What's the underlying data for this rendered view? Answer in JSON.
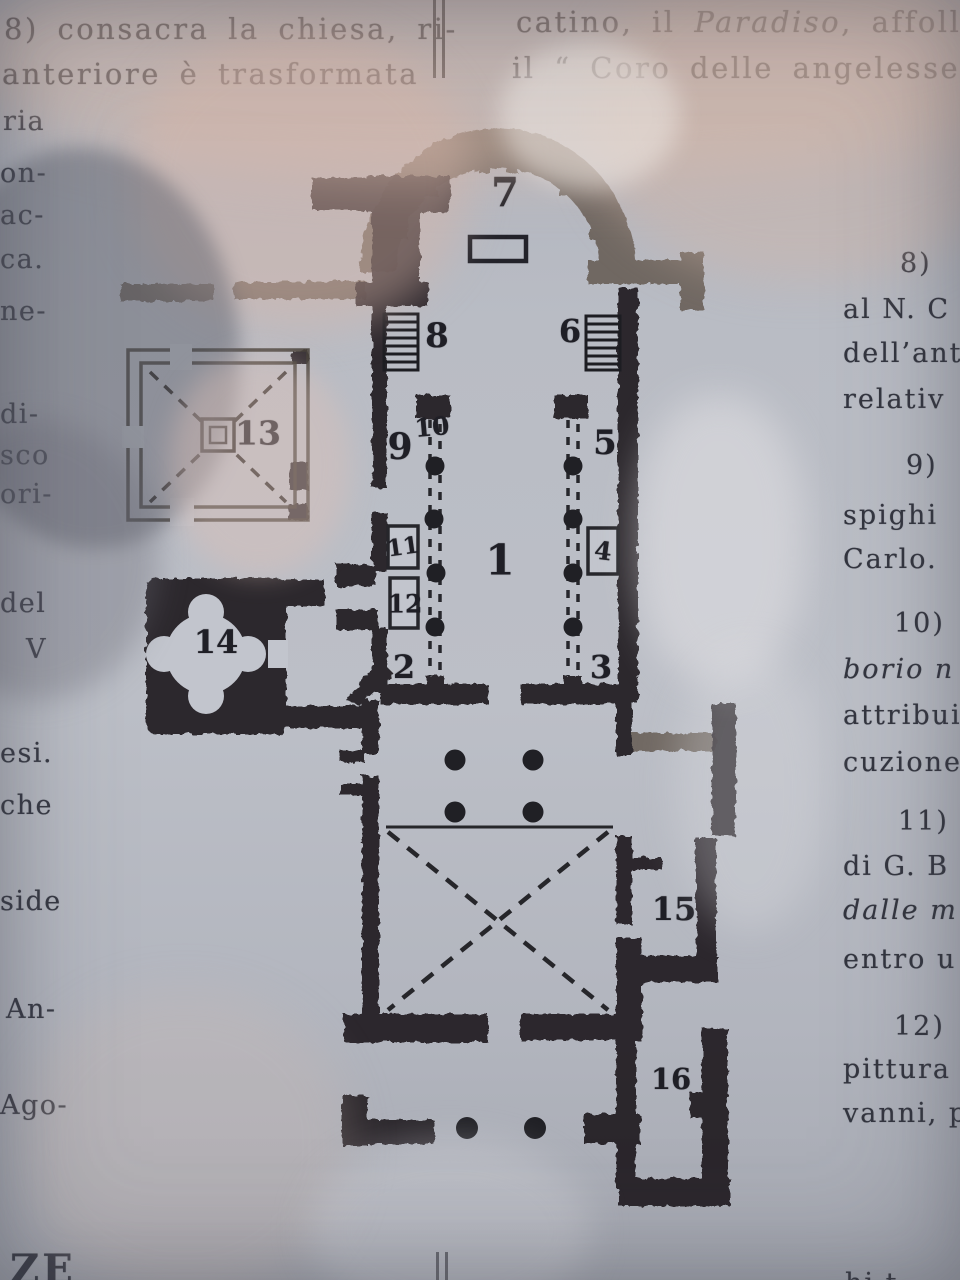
{
  "colors": {
    "ink": "#26262b",
    "paper": "#bcbfc7",
    "faded_wall": "#4a443e",
    "reflection_beige": "#d7b9aa",
    "shadow_gray": "#5f606a"
  },
  "page": {
    "left_column": {
      "line1": "8) consacra la chiesa, ri-",
      "line2": "anteriore è trasformata",
      "margin_fragments": [
        "ria",
        "on-",
        "ac-",
        "ca.",
        "ne-",
        "di-",
        "sco",
        "ori-",
        "del",
        "V",
        "esi.",
        "che",
        "side",
        "An-",
        "Ago-"
      ],
      "bottom_heading_fragment": "ZE"
    },
    "right_column": {
      "line1a": "catino, il ",
      "line1b": "Paradiso",
      "line1c": ", affollat",
      "line2": "il “ Coro delle angelesse „ p",
      "fragments": [
        "8)",
        "al N. C",
        "dell’ant",
        "relativ",
        "9)",
        "spighi",
        "Carlo.",
        "10)",
        "borio n",
        "attribui",
        "cuzione",
        "11)",
        "di G. B",
        "dalle m",
        "entro u",
        "12)",
        "pittura",
        "vanni, p"
      ],
      "bottom_partial": "hi t"
    },
    "plan": {
      "labels": [
        "1",
        "2",
        "3",
        "4",
        "5",
        "6",
        "7",
        "8",
        "9",
        "10",
        "11",
        "12",
        "13",
        "14",
        "15",
        "16"
      ]
    }
  }
}
